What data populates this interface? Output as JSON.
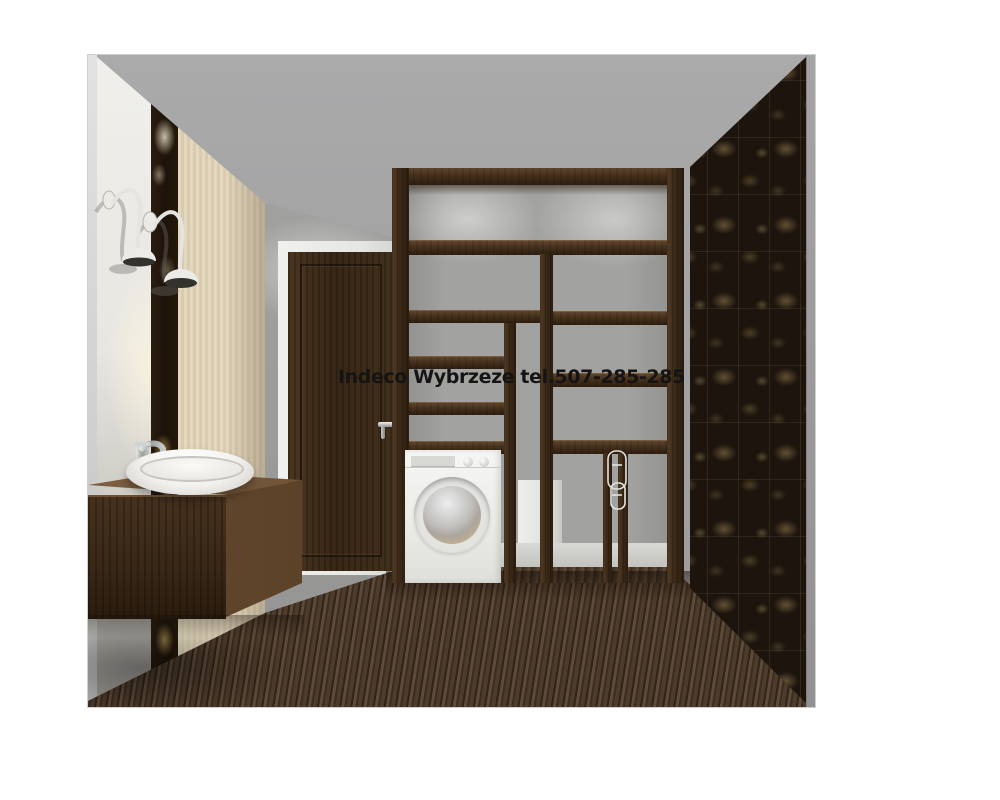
{
  "watermark": {
    "text": "Indeco Wybrzeze tel.507-285-285",
    "color": "#141414"
  },
  "scene": {
    "type": "interior-3d-visualization",
    "objects": [
      "gooseneck-wall-lamp",
      "gooseneck-wall-lamp",
      "vessel-sink",
      "chrome-faucet",
      "floating-vanity-cabinet",
      "interior-door",
      "door-handle",
      "open-wardrobe-shelving",
      "washing-machine",
      "wire-drying-rack",
      "floral-accent-strip",
      "striped-beige-wallpaper",
      "dark-floral-wallpaper",
      "wood-plank-floor",
      "baseboard",
      "utility-box"
    ]
  },
  "palette": {
    "canvas": "#ffffff",
    "ceiling": "#a4a4a5",
    "back_wall": "#9c9c9a",
    "left_wall_lit": "#eeece7",
    "accent_strip_dark": "#20150c",
    "accent_floral_gold": "#a98d52",
    "beige_wallpaper": "#ddd1b6",
    "wenge_wood": "#3a2917",
    "door_wood": "#3b2a19",
    "floor_wood": "#46352a",
    "right_wallpaper_base": "#1d140d",
    "right_wallpaper_floral": "#8a7750",
    "wall_edge_strip": "#9b9a9b",
    "washer_white": "#f2f2f0",
    "sink_white": "#f7f6f3",
    "watermark_text": "#141414"
  }
}
